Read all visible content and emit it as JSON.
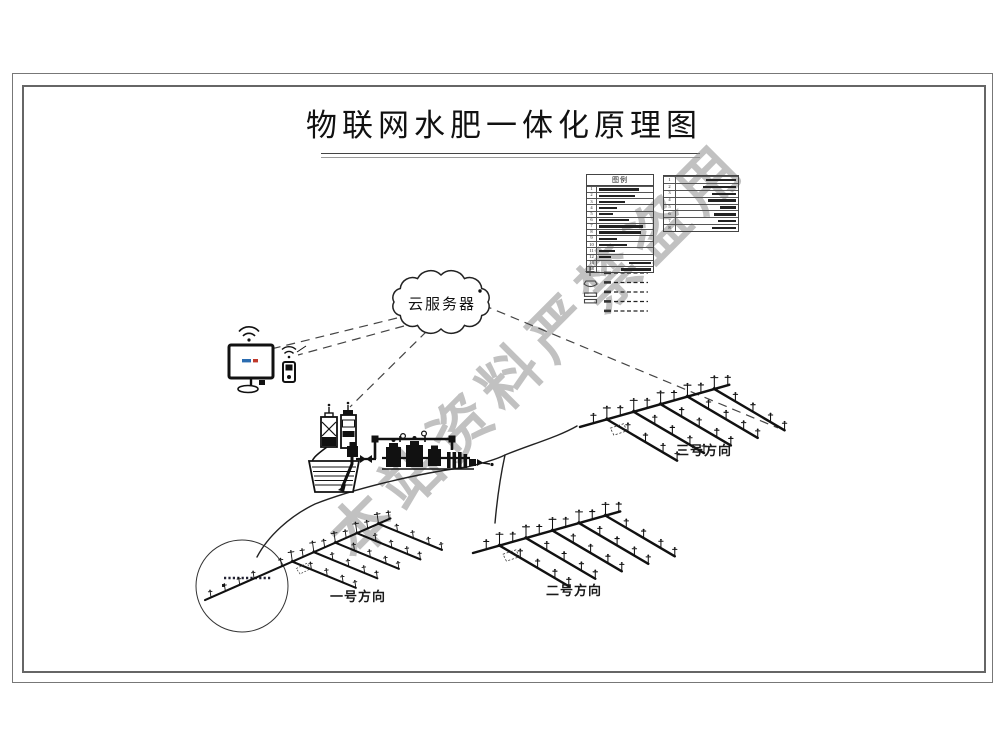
{
  "title": "物联网水肥一体化原理图",
  "watermark": "本站资料严禁盗用",
  "cloud": {
    "label": "云服务器"
  },
  "legend": {
    "header": "图例",
    "main_table_rows": [
      {
        "num": "1"
      },
      {
        "num": "2"
      },
      {
        "num": "3"
      },
      {
        "num": "4"
      },
      {
        "num": "5"
      },
      {
        "num": "6"
      },
      {
        "num": "7"
      },
      {
        "num": "8"
      },
      {
        "num": "9"
      },
      {
        "num": "10"
      },
      {
        "num": "11"
      },
      {
        "num": "12"
      },
      {
        "num": "13"
      },
      {
        "num": "14"
      }
    ],
    "secondary_table_rows": [
      {
        "num": "1"
      },
      {
        "num": "2"
      },
      {
        "num": "3"
      },
      {
        "num": "4"
      },
      {
        "num": "5"
      },
      {
        "num": "6"
      },
      {
        "num": "7"
      },
      {
        "num": "8"
      }
    ]
  },
  "fields": [
    {
      "label": "一号方向"
    },
    {
      "label": "二号方向"
    },
    {
      "label": "三号方向"
    }
  ],
  "icons": {
    "cloud": "cloud-shape",
    "monitor": "monitor-icon",
    "mobile": "mobile-icon",
    "wifi": "wifi-icon"
  },
  "colors": {
    "line": "#1a1a1a",
    "watermark": "#8f8f8f",
    "frame": "#666666"
  }
}
